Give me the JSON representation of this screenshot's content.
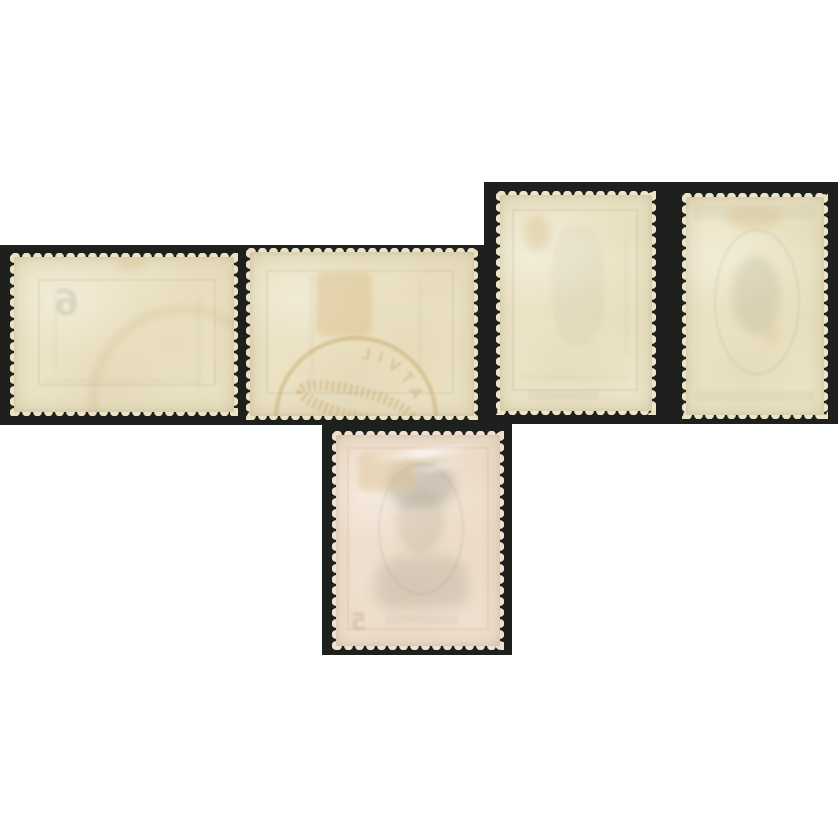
{
  "scene": {
    "kind": "photograph",
    "subject": "reverse (gum side) of five perforated postage stamps on a dark stock card",
    "stamp_count": 5
  },
  "palette": {
    "background": "#ffffff",
    "mount": "#1d201d",
    "showthrough_gray": "#6e7a80",
    "postmark_tan": "#c8a76e",
    "hinge_tan": "#dcc392"
  },
  "mount_blocks": [
    {
      "name": "left",
      "x": 0,
      "y": 245,
      "w": 490,
      "h": 180
    },
    {
      "name": "right",
      "x": 484,
      "y": 182,
      "w": 354,
      "h": 242
    },
    {
      "name": "bottom",
      "x": 322,
      "y": 422,
      "w": 190,
      "h": 233
    }
  ],
  "stamps": [
    {
      "id": 1,
      "orientation": "landscape",
      "x": 10,
      "y": 253,
      "w": 228,
      "h": 163,
      "gum": "#ece3c5",
      "ghost_digit": "6",
      "marks": [
        "faint mirrored numeral 6",
        "ghost frame lines",
        "partial tan arc lower right"
      ]
    },
    {
      "id": 2,
      "orientation": "landscape",
      "x": 246,
      "y": 248,
      "w": 232,
      "h": 172,
      "gum": "#ebe2c3",
      "postmark_glyphs": "ATVIL",
      "marks": [
        "tan hinge remnant",
        "mirrored circular datestamp with killer bars",
        "ghost frame lines"
      ]
    },
    {
      "id": 3,
      "orientation": "portrait",
      "x": 496,
      "y": 191,
      "w": 160,
      "h": 224,
      "gum": "#ede5c8",
      "marks": [
        "ghost frame lines",
        "small tan smudge upper left"
      ]
    },
    {
      "id": 4,
      "orientation": "portrait",
      "x": 682,
      "y": 193,
      "w": 146,
      "h": 226,
      "gum": "#ece4c6",
      "marks": [
        "ghost oval portrait frame",
        "tan smudge top",
        "ghost bands"
      ]
    },
    {
      "id": 5,
      "orientation": "portrait",
      "x": 332,
      "y": 431,
      "w": 172,
      "h": 219,
      "gum": "#f0e0cf",
      "ghost_digit": "5",
      "marks": [
        "ghost portrait show-through",
        "tan hinge remnant",
        "gum shine streaks",
        "faint reddish frame",
        "faint mirrored numeral 5"
      ]
    }
  ]
}
